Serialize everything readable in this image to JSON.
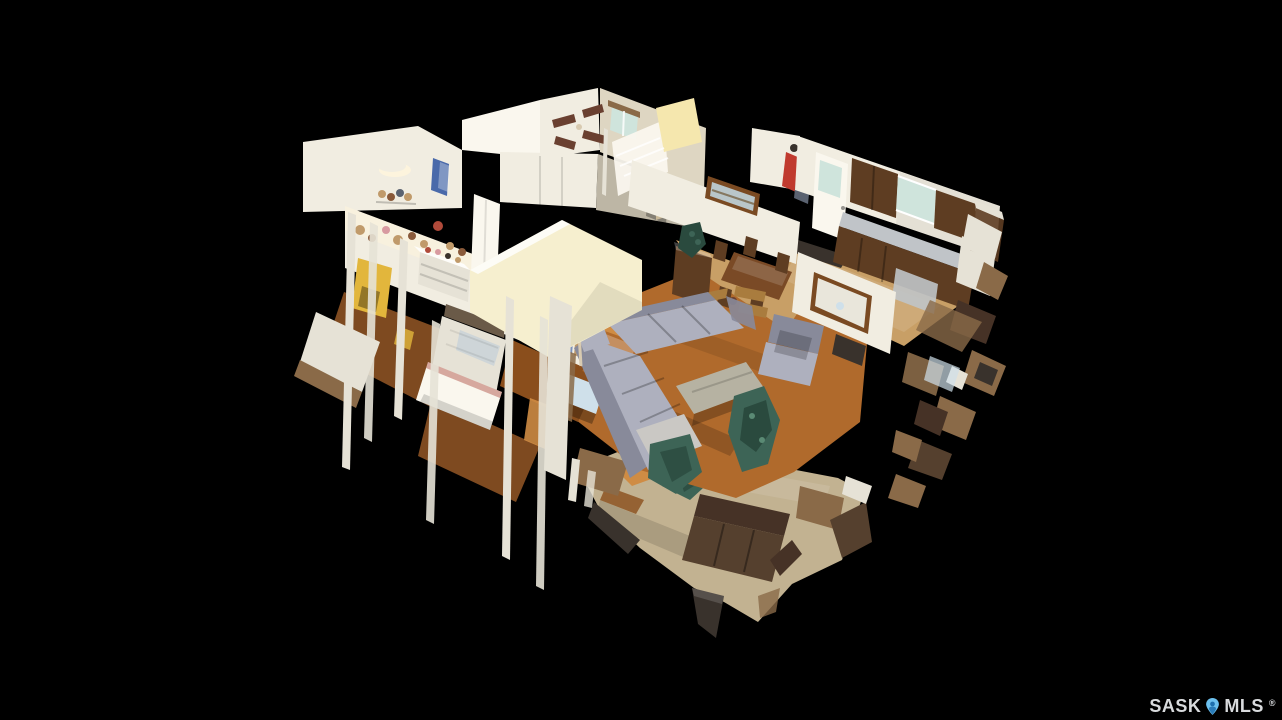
{
  "scene": {
    "description": "3D dollhouse cutaway view of a single-storey home with basement, shown floating on a black background (virtual tour render)",
    "rooms": [
      "kids bedroom",
      "second bedroom",
      "master bedroom",
      "hallway",
      "stairwell",
      "dining area",
      "kitchen",
      "living room",
      "basement family room"
    ]
  },
  "watermark": {
    "brand_left": "SASK",
    "brand_right": "MLS",
    "registered": "®"
  },
  "palette": {
    "bg": "#000000",
    "wall": "#f1ede1",
    "wallBright": "#faf7ee",
    "wallShadow": "#ded6c2",
    "wallCream": "#f6efcf",
    "whiteFrag": "#e6e2d6",
    "glow": "#f5e7ae",
    "slotTan": "#c9b998",
    "woodFloor": "#b06a2c",
    "woodDark": "#8a4e1c",
    "woodLight": "#cf8c44",
    "diningFloor": "#c89f66",
    "bedroomFloor": "#7e4a20",
    "carpet": "#c2b291",
    "sofa": "#aeb0be",
    "sofaDark": "#888a9a",
    "throw": "#cac8c4",
    "tableGray": "#b6b2a2",
    "couch": "#55402e",
    "couchDark": "#463226",
    "benchWood": "#8a6a48",
    "darkFrag": "#39322c",
    "cabinet": "#5e3d22",
    "tableWood": "#7a4a26",
    "counter": "#c0c4c8",
    "window": "#cfe4dc",
    "artSky": "#b9c6c9",
    "plant": "#3d6456",
    "plantDark": "#2a4a3e",
    "plantLight": "#5a8a74",
    "gold": "#e2b63c",
    "fan": "#6a4030",
    "fanWood": "#a97c3e",
    "mirror": "#7a4a22",
    "headboard": "#6a5a48",
    "bedBlue": "#cfe0ea",
    "clothesBlue": "#4a6aaa",
    "moon": "#fdf4dd",
    "lampShade": "#d8cab0",
    "jacketRed": "#c03a2e",
    "jacketGray": "#5a6270",
    "toyTan": "#c09a6a",
    "toyBrown": "#8a5a3a",
    "toyPink": "#d89aa0",
    "toyRed": "#b04a3a",
    "text": "#d9dbdd",
    "pin": "#6cc0ee",
    "pinDark": "#1d6fae"
  }
}
